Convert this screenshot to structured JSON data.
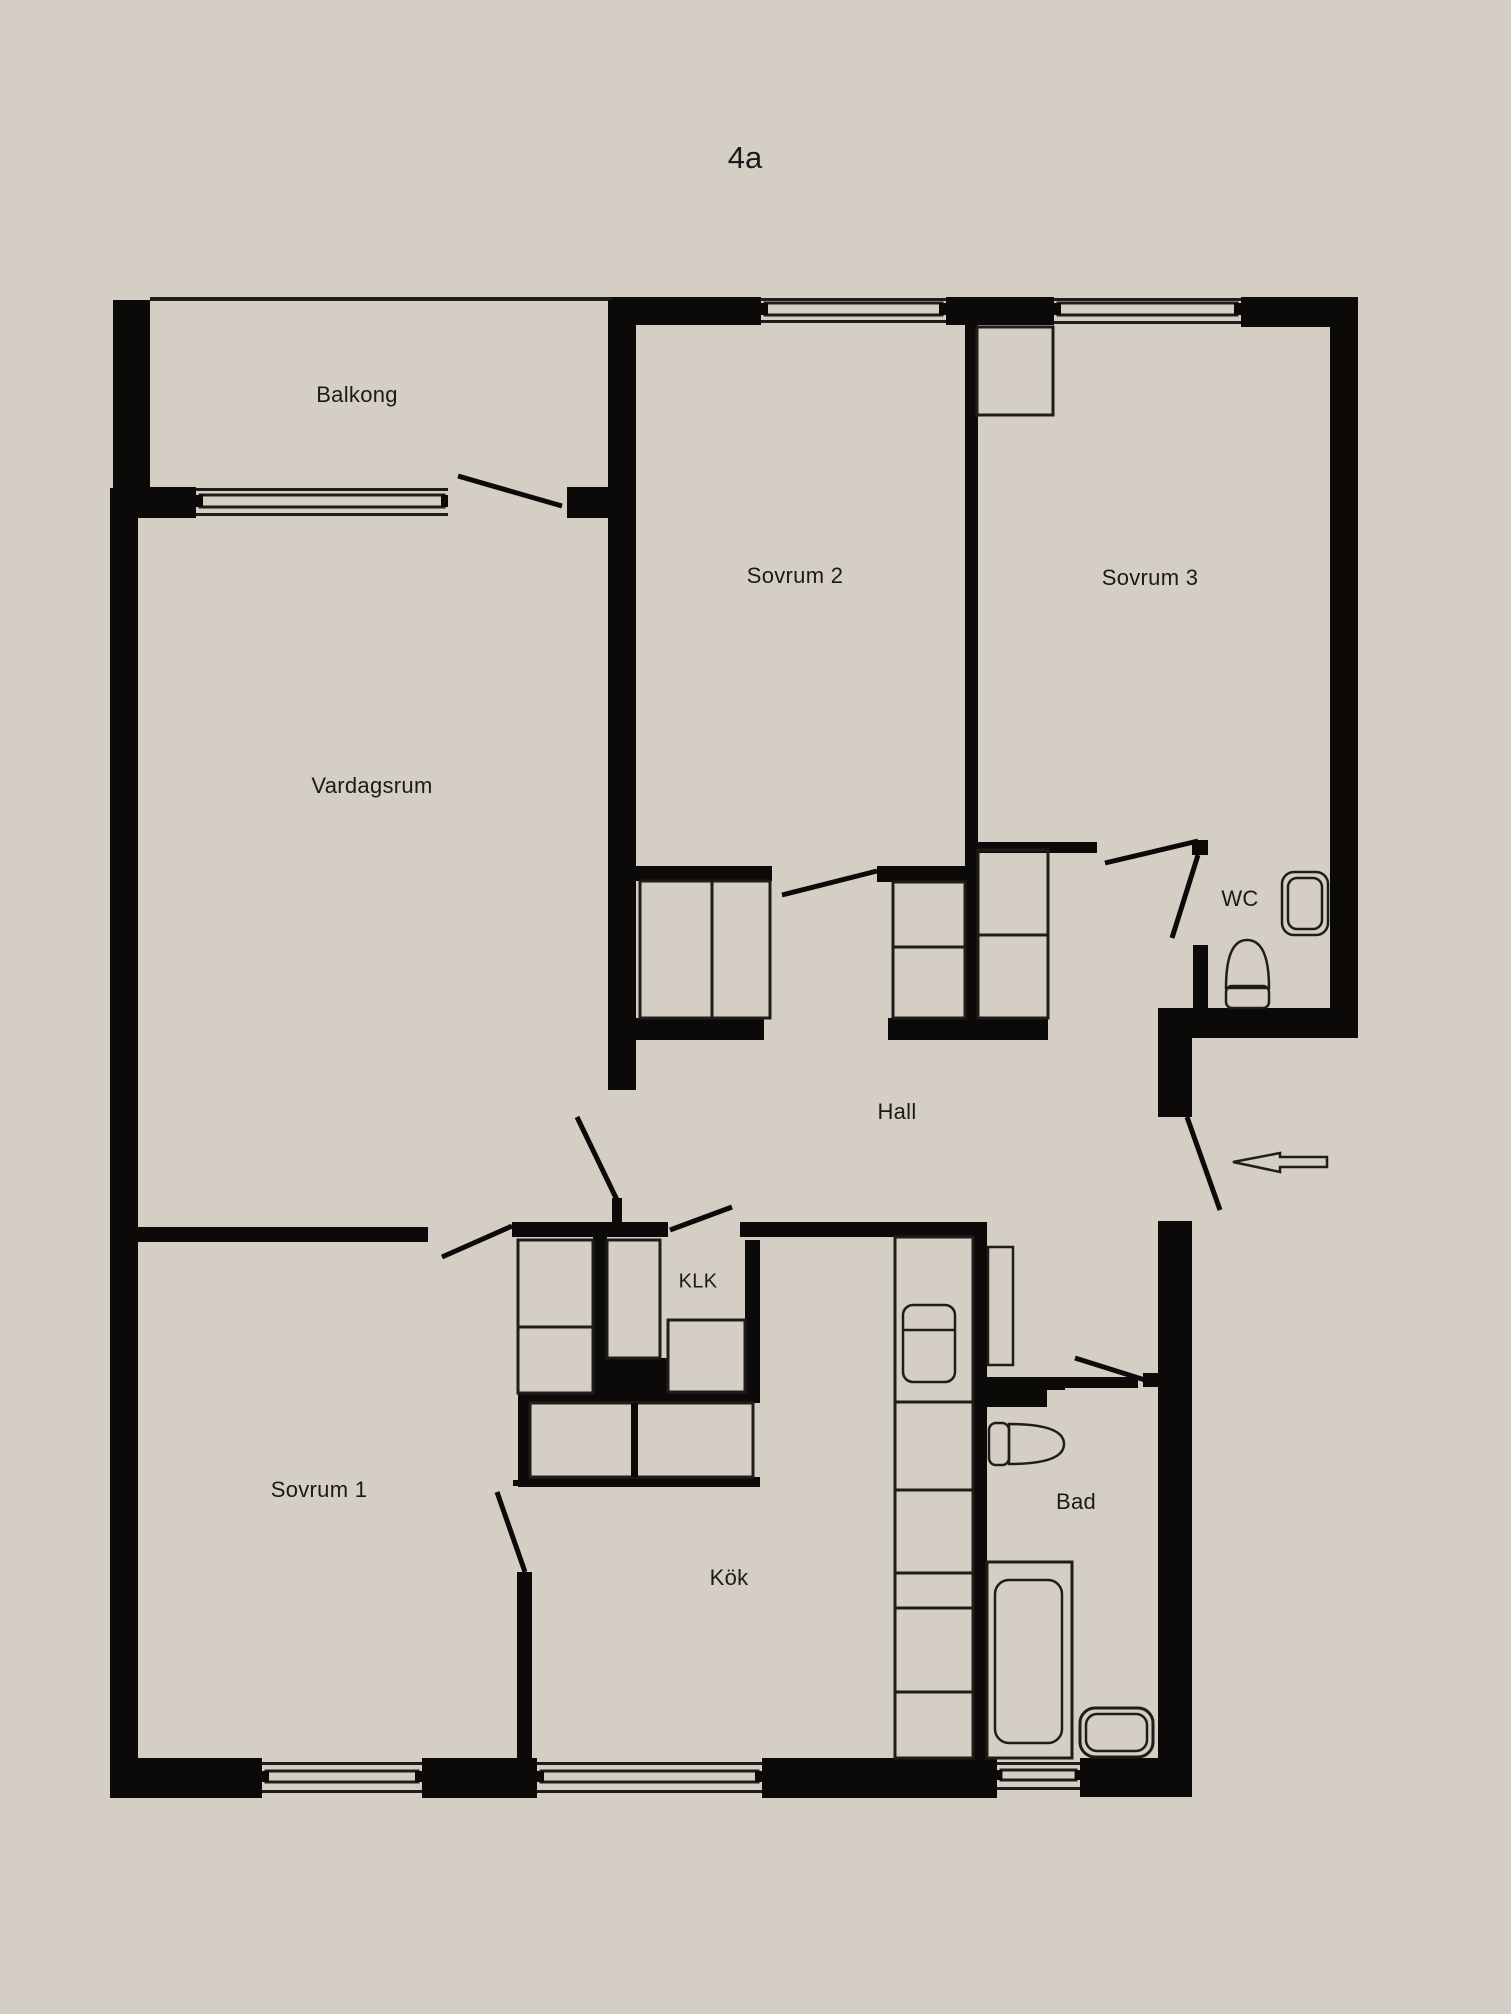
{
  "title": "4a",
  "colors": {
    "background": "#d5cec5",
    "wall": "#0b0a08",
    "line": "#1f1d1a",
    "text": "#1a1a1a"
  },
  "rooms": {
    "balkong": {
      "label": "Balkong"
    },
    "vardagsrum": {
      "label": "Vardagsrum"
    },
    "sovrum2": {
      "label": "Sovrum 2"
    },
    "sovrum3": {
      "label": "Sovrum 3"
    },
    "wc": {
      "label": "WC"
    },
    "hall": {
      "label": "Hall"
    },
    "klk": {
      "label": "KLK"
    },
    "sovrum1": {
      "label": "Sovrum 1"
    },
    "kok": {
      "label": "Kök"
    },
    "bad": {
      "label": "Bad"
    }
  },
  "fixtures": [
    "wc-sink",
    "wc-toilet",
    "bad-toilet",
    "bathtub",
    "washbasin",
    "kitchen-appliance",
    "entrance-arrow"
  ]
}
